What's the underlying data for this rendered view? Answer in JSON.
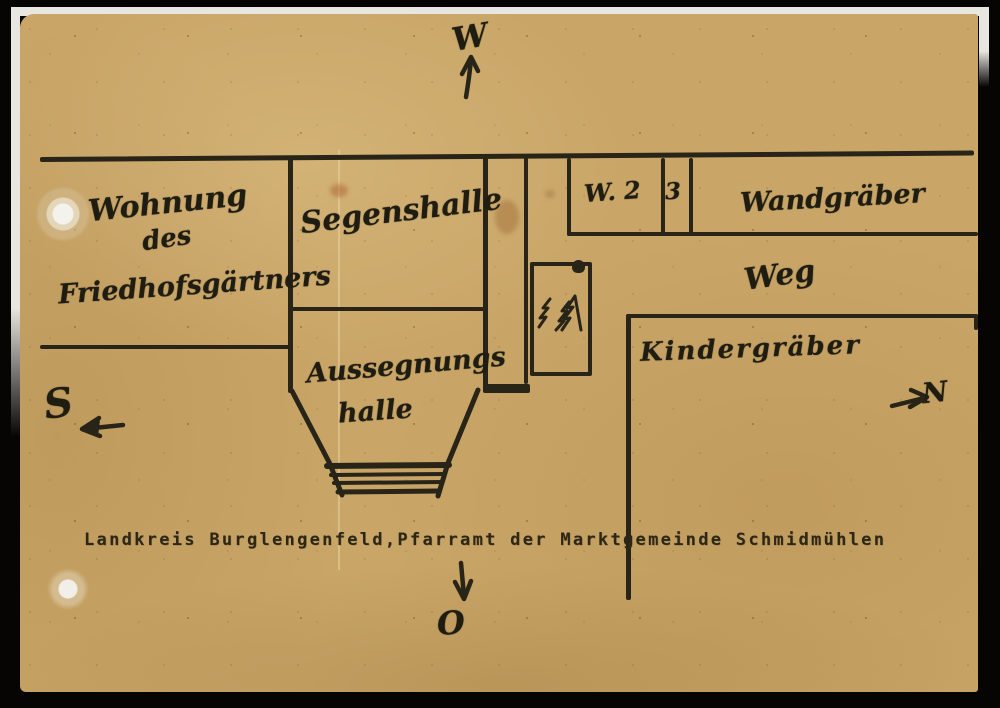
{
  "scan": {
    "caption": "Landkreis Burglengenfeld,Pfarramt der Marktgemeinde Schmidmühlen"
  },
  "compass": {
    "west": "W",
    "south": "S",
    "north": "N",
    "east": "O"
  },
  "plan": {
    "gardener_house": {
      "line1": "Wohnung",
      "line2": "des",
      "line3": "Friedhofsgärtners"
    },
    "building": {
      "upper_hall": "Segenshalle",
      "lower_hall_line1": "Aussegnungs",
      "lower_hall_line2": "halle"
    },
    "wall_graves": {
      "cell_w2": "W. 2",
      "cell_3": "3",
      "label": "Wandgräber"
    },
    "path": "Weg",
    "children_graves": "Kindergräber"
  },
  "icons": {
    "trees": "pine-trees-icon",
    "arrow_up": "arrow-up-icon",
    "arrow_left": "arrow-left-icon",
    "arrow_right": "arrow-right-icon",
    "arrow_down": "arrow-down-icon"
  },
  "colors": {
    "paper": "#c9a668",
    "ink": "#282418",
    "background": "#060504"
  }
}
